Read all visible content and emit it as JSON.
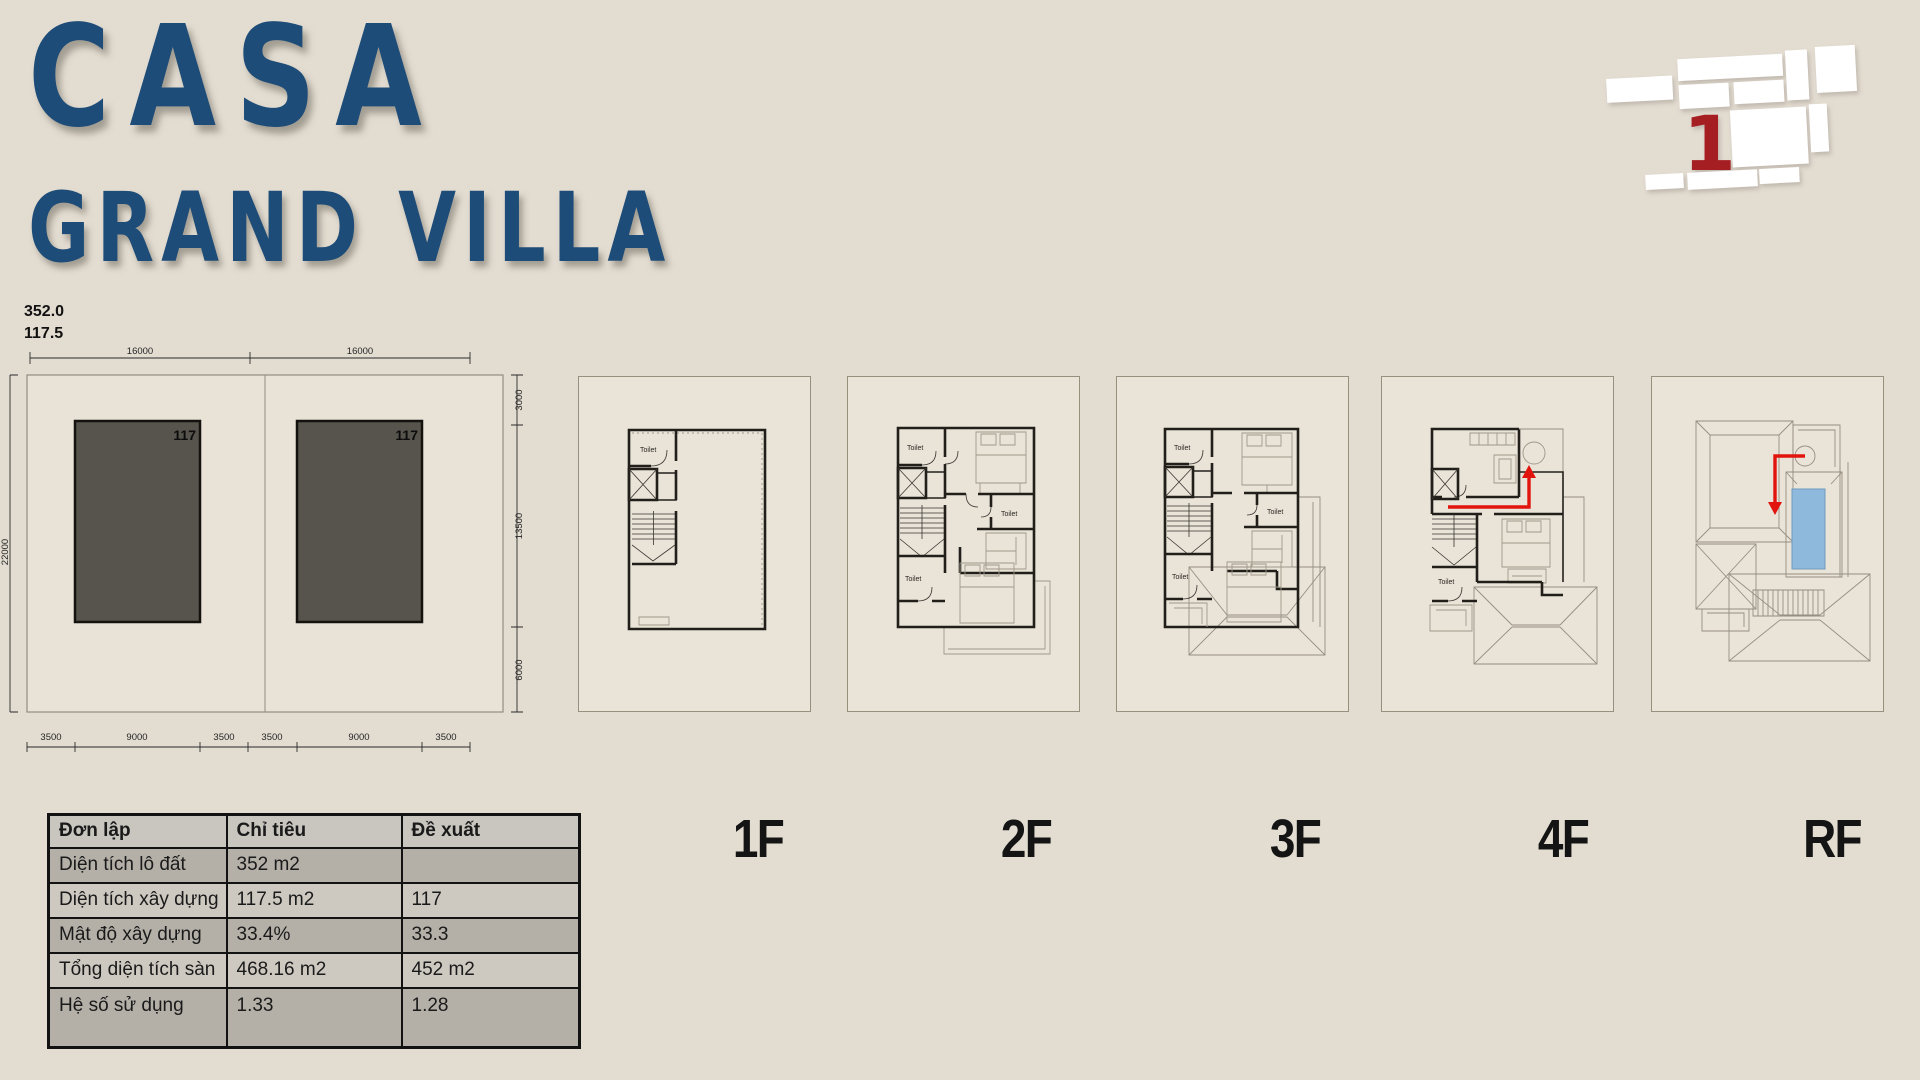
{
  "header": {
    "title_line1": "CASA",
    "title_line2": "GRAND VILLA",
    "title_color": "#1d4c78"
  },
  "locator": {
    "unit_number": "1",
    "highlight_color": "#a51e22"
  },
  "site_plan": {
    "area_label": "352.0",
    "footprint_label": "117.5",
    "unit_area_left": "117",
    "unit_area_right": "117",
    "dim_top": [
      "16000",
      "16000"
    ],
    "dim_bottom": [
      "3500",
      "9000",
      "3500",
      "3500",
      "9000",
      "3500"
    ],
    "dim_right": [
      "3000",
      "13500",
      "6000"
    ],
    "dim_left": "22000"
  },
  "floors": [
    {
      "id": "1f",
      "label": "1F",
      "toilets": [
        "Toilet"
      ]
    },
    {
      "id": "2f",
      "label": "2F",
      "toilets": [
        "Toilet",
        "Toilet",
        "Toilet"
      ]
    },
    {
      "id": "3f",
      "label": "3F",
      "toilets": [
        "Toilet",
        "Toilet",
        "Toilet"
      ]
    },
    {
      "id": "4f",
      "label": "4F",
      "toilets": [
        "Toilet"
      ]
    },
    {
      "id": "rf",
      "label": "RF",
      "toilets": []
    }
  ],
  "accents": {
    "route_arrow_color": "#e2140e",
    "pool_color": "#8fb9dc"
  },
  "table": {
    "headers": [
      "Đơn lập",
      "Chỉ tiêu",
      "Đề xuất"
    ],
    "rows": [
      [
        "Diện tích lô đất",
        "352 m2",
        ""
      ],
      [
        "Diện tích xây dựng",
        "117.5 m2",
        "117"
      ],
      [
        "Mật độ xây dựng",
        "33.4%",
        "33.3"
      ],
      [
        "Tổng diện tích sàn",
        "468.16 m2",
        "452 m2"
      ],
      [
        "Hệ số sử dụng",
        "1.33",
        "1.28"
      ]
    ]
  }
}
